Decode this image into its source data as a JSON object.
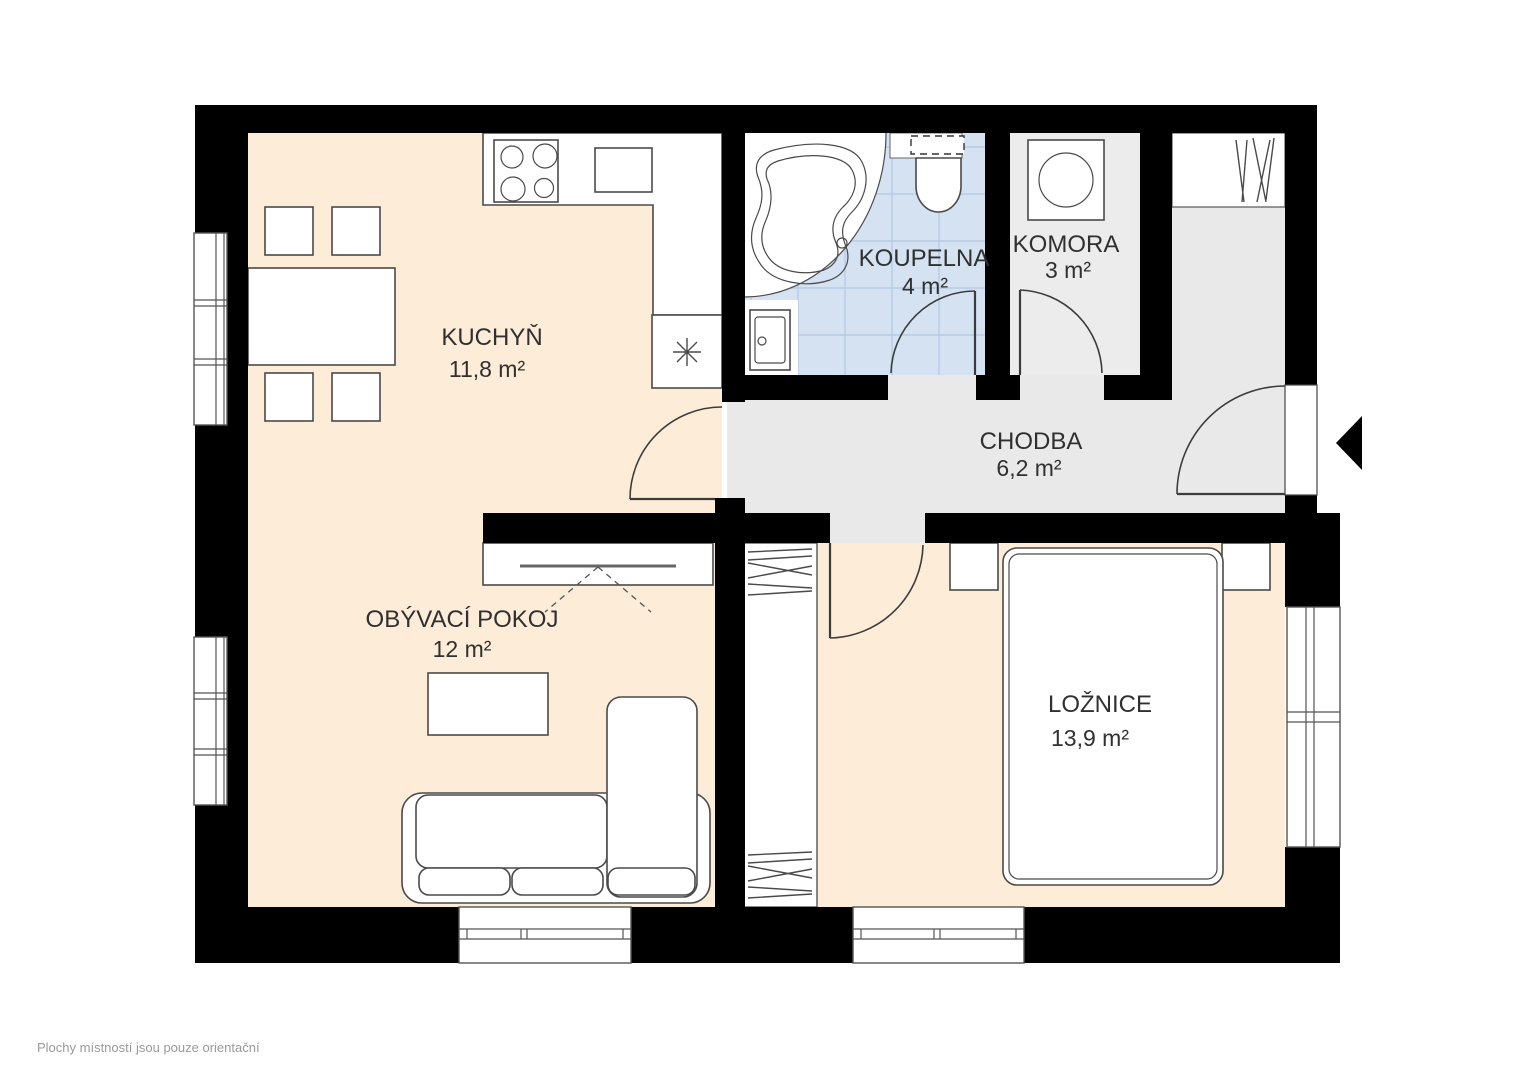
{
  "rooms": {
    "kuchyn": {
      "name": "KUCHYŇ",
      "area": "11,8 m²"
    },
    "koupelna": {
      "name": "KOUPELNA",
      "area": "4 m²"
    },
    "komora": {
      "name": "KOMORA",
      "area": "3 m²"
    },
    "chodba": {
      "name": "CHODBA",
      "area": "6,2 m²"
    },
    "obyvaci": {
      "name": "OBÝVACÍ POKOJ",
      "area": "12 m²"
    },
    "loznice": {
      "name": "LOŽNICE",
      "area": "13,9 m²"
    }
  },
  "footer": {
    "disclaimer": "Plochy místností jsou pouze orientační"
  },
  "icons": {
    "entrance_arrow": "left-pointing-triangle"
  },
  "colors": {
    "floor_warm": "#fcecd8",
    "floor_hall": "#e9e9e9",
    "floor_storage": "#ececec",
    "floor_bath": "#d4e2f2",
    "tile_line": "#b7cbe5",
    "wall": "#000000",
    "furniture_line": "#4a4a4a",
    "text": "#303030",
    "footer_text": "#9a9a9a"
  }
}
